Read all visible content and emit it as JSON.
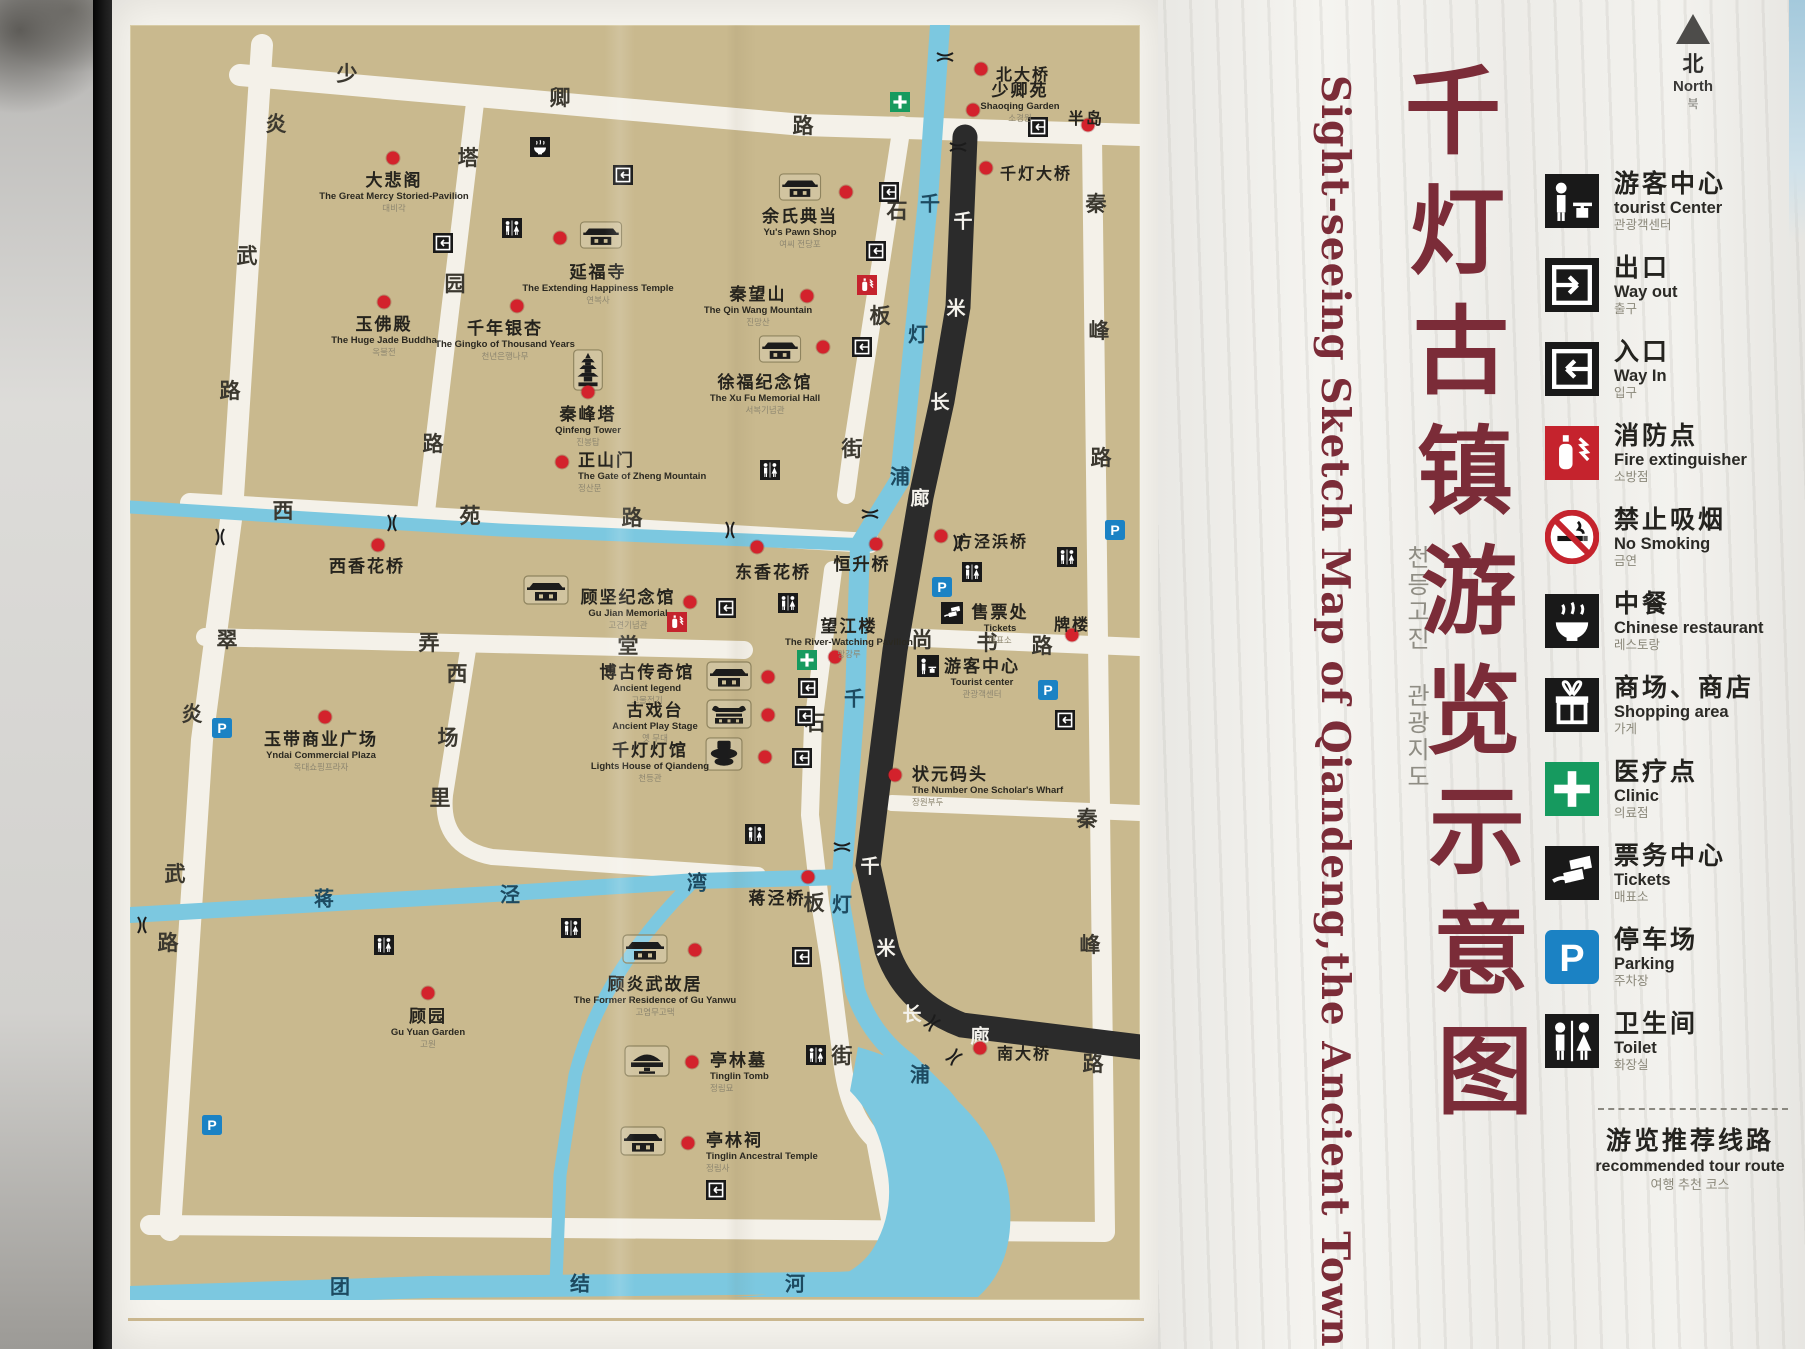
{
  "colors": {
    "map_tan": "#c9b98e",
    "river_blue": "#7cc8e0",
    "corridor_black": "#2b2b2b",
    "poi_dot_red": "#d3222c",
    "title_maroon": "#7b2c38",
    "clinic_green": "#169a5f",
    "parking_blue": "#1b82c4",
    "fire_red": "#c5232d"
  },
  "sign": {
    "title": {
      "zh_chars": [
        "千",
        "灯",
        "古",
        "镇",
        "游",
        "览",
        "示",
        "意",
        "图"
      ],
      "en": "Sight-seeing Sketch Map of Qiandeng,the Ancient Town",
      "ko": "천등고진 관광지도"
    },
    "north": {
      "zh": "北",
      "en": "North",
      "ko": "북"
    },
    "legend": {
      "items": [
        {
          "zh": "游客中心",
          "en": "tourist Center",
          "ko": "관광객센터",
          "icon": "tourist-center"
        },
        {
          "zh": "出口",
          "en": "Way out",
          "ko": "출구",
          "icon": "way-out"
        },
        {
          "zh": "入口",
          "en": "Way In",
          "ko": "입구",
          "icon": "way-in"
        },
        {
          "zh": "消防点",
          "en": "Fire extinguisher",
          "ko": "소방점",
          "icon": "fire-extinguisher"
        },
        {
          "zh": "禁止吸烟",
          "en": "No Smoking",
          "ko": "금연",
          "icon": "no-smoking"
        },
        {
          "zh": "中餐",
          "en": "Chinese restaurant",
          "ko": "레스토랑",
          "icon": "chinese-restaurant"
        },
        {
          "zh": "商场、商店",
          "en": "Shopping area",
          "ko": "가게",
          "icon": "shopping-area"
        },
        {
          "zh": "医疗点",
          "en": "Clinic",
          "ko": "의료점",
          "icon": "clinic"
        },
        {
          "zh": "票务中心",
          "en": "Tickets",
          "ko": "매표소",
          "icon": "tickets"
        },
        {
          "zh": "停车场",
          "en": "Parking",
          "ko": "주차장",
          "icon": "parking"
        },
        {
          "zh": "卫生间",
          "en": "Toilet",
          "ko": "화장실",
          "icon": "toilet"
        }
      ],
      "route": {
        "zh": "游览推荐线路",
        "en": "recommended tour route",
        "ko": "여행 추천 코스"
      }
    }
  },
  "map": {
    "roads": {
      "yanwu": [
        "炎",
        "武",
        "路"
      ],
      "shaoqing": [
        "少",
        "卿",
        "路"
      ],
      "tayuan": [
        "塔",
        "园",
        "路"
      ],
      "xiyuan": [
        "西",
        "苑",
        "路"
      ],
      "cuinongtang": [
        "翠",
        "弄",
        "堂"
      ],
      "shangshu": [
        "尚",
        "书",
        "路"
      ],
      "xichangli": [
        "西",
        "场",
        "里"
      ],
      "shiban": [
        "石",
        "板",
        "街"
      ],
      "qinfenglu": [
        "秦",
        "峰",
        "路"
      ],
      "jiangjingwan": [
        "蒋",
        "泾",
        "湾"
      ],
      "tuanjiehe": [
        "团",
        "结",
        "河"
      ],
      "qiandengpu": [
        "千",
        "灯",
        "浦"
      ],
      "corridor": [
        "千",
        "米",
        "长",
        "廊"
      ]
    },
    "pois": [
      {
        "zh": "大悲阁",
        "en": "The Great Mercy Storied-Pavilion",
        "ko": "대비각"
      },
      {
        "zh": "玉佛殿",
        "en": "The Huge Jade Buddha",
        "ko": "옥불전"
      },
      {
        "zh": "延福寺",
        "en": "The Extending Happiness Temple",
        "ko": "연복사"
      },
      {
        "zh": "千年银杏",
        "en": "The Gingko of Thousand Years",
        "ko": "천년은행나무"
      },
      {
        "zh": "秦峰塔",
        "en": "Qinfeng Tower",
        "ko": "진봉탑"
      },
      {
        "zh": "正山门",
        "en": "The Gate of Zheng Mountain",
        "ko": "정산문"
      },
      {
        "zh": "徐福纪念馆",
        "en": "The Xu Fu Memorial Hall",
        "ko": "서복기념관"
      },
      {
        "zh": "余氏典当",
        "en": "Yu's Pawn Shop",
        "ko": "여씨 전당포"
      },
      {
        "zh": "秦望山",
        "en": "The Qin Wang Mountain",
        "ko": "진망산"
      },
      {
        "zh": "少卿苑",
        "en": "Shaoqing Garden",
        "ko": "소경원"
      },
      {
        "zh": "顾坚纪念馆",
        "en": "Gu Jian Memorial",
        "ko": "고견기념관"
      },
      {
        "zh": "望江楼",
        "en": "The River-Watching Pavilion",
        "ko": "망강루"
      },
      {
        "zh": "售票处",
        "en": "Tickets",
        "ko": "매표소"
      },
      {
        "zh": "游客中心",
        "en": "Tourist center",
        "ko": "관광객센터"
      },
      {
        "zh": "状元码头",
        "en": "The Number One Scholar's Wharf",
        "ko": "장원부두"
      },
      {
        "zh": "博古传奇馆",
        "en": "Ancient legend",
        "ko": "고물전기"
      },
      {
        "zh": "古戏台",
        "en": "Ancient Play Stage",
        "ko": "옛 무대"
      },
      {
        "zh": "千灯灯馆",
        "en": "Lights House of Qiandeng",
        "ko": "천등관"
      },
      {
        "zh": "玉带商业广场",
        "en": "Yndai Commercial Plaza",
        "ko": "옥대쇼핑프라자"
      },
      {
        "zh": "顾园",
        "en": "Gu Yuan Garden",
        "ko": "고원"
      },
      {
        "zh": "顾炎武故居",
        "en": "The Former Residence of Gu Yanwu",
        "ko": "고염무고택"
      },
      {
        "zh": "亭林墓",
        "en": "Tinglin Tomb",
        "ko": "정림묘"
      },
      {
        "zh": "亭林祠",
        "en": "Tinglin Ancestral Temple",
        "ko": "정림사"
      }
    ],
    "bridges": [
      "北大桥",
      "千灯大桥",
      "半岛",
      "西香花桥",
      "东香花桥",
      "恒升桥",
      "方泾浜桥",
      "蒋泾桥",
      "南大桥",
      "牌楼"
    ]
  }
}
